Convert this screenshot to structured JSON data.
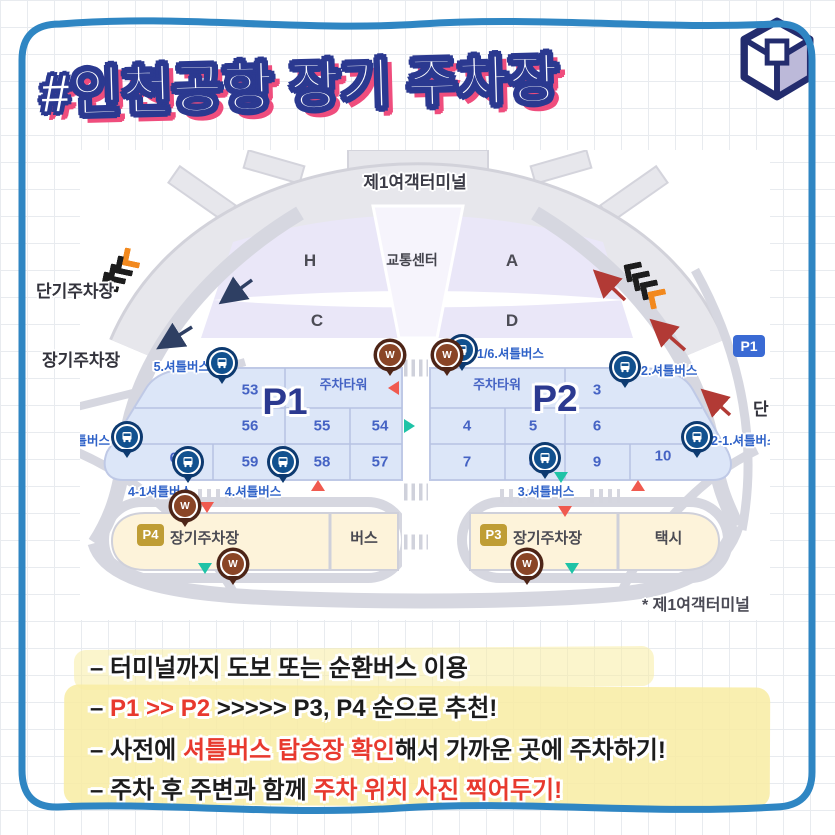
{
  "title": {
    "text": "#인천공항 장기 주차장"
  },
  "colors": {
    "frame_blue": "#2f86c3",
    "title_outline": "#2b3990",
    "title_shadow": "#ef4d7d",
    "red_accent": "#e8392e",
    "highlight_yellow": "#f8eca2",
    "parking_fill": "#dce6f8",
    "lot_fill": "#fdf3da",
    "badge_gold": "#bf9d35"
  },
  "map": {
    "terminal_label": "제1여객터미널",
    "transport_center": "교통센터",
    "gates": {
      "h": "H",
      "a": "A",
      "c": "C",
      "d": "D"
    },
    "short_term_label": "단기주차장",
    "long_term_label": "장기주차장",
    "short_label": "단",
    "p1_badge": "P1",
    "w_letter": "W",
    "p1": {
      "label": "P1",
      "tower": "주차타워",
      "numbers": [
        "53",
        "56",
        "55",
        "54",
        "60",
        "59",
        "58",
        "57"
      ]
    },
    "p2": {
      "label": "P2",
      "tower": "주차타워",
      "numbers": [
        "3",
        "4",
        "5",
        "6",
        "7",
        "8",
        "9",
        "10"
      ]
    },
    "stops": {
      "s5": "5.셔틀버스",
      "s16": "1/6.셔틀버스",
      "s2": "2.셔틀버스",
      "s21": "2-1.셔틀버스",
      "s6": "셔틀버스",
      "s41": "4-1셔틀버스",
      "s4": "4.셔틀버스",
      "s3": "3.셔틀버스"
    },
    "lots": {
      "p4_badge": "P4",
      "p4_label": "장기주차장",
      "bus": "버스",
      "p3_badge": "P3",
      "p3_label": "장기주차장",
      "taxi": "택시"
    },
    "footnote": "* 제1여객터미널"
  },
  "tips": {
    "line1": {
      "seg1": "– 터미널까지 도보 또는 순환버스 이용"
    },
    "line2": {
      "seg1": "– ",
      "seg2": "P1 >> P2",
      "seg3": " >>>>> P3, P4 순으로 추천!"
    },
    "line3": {
      "seg1": "– 사전에 ",
      "seg2": "셔틀버스 탑승장 확인",
      "seg3": "해서 가까운 곳에 주차하기!"
    },
    "line4": {
      "seg1": "– 주차 후 주변과 함께 ",
      "seg2": "주차 위치 사진 찍어두기!"
    }
  }
}
